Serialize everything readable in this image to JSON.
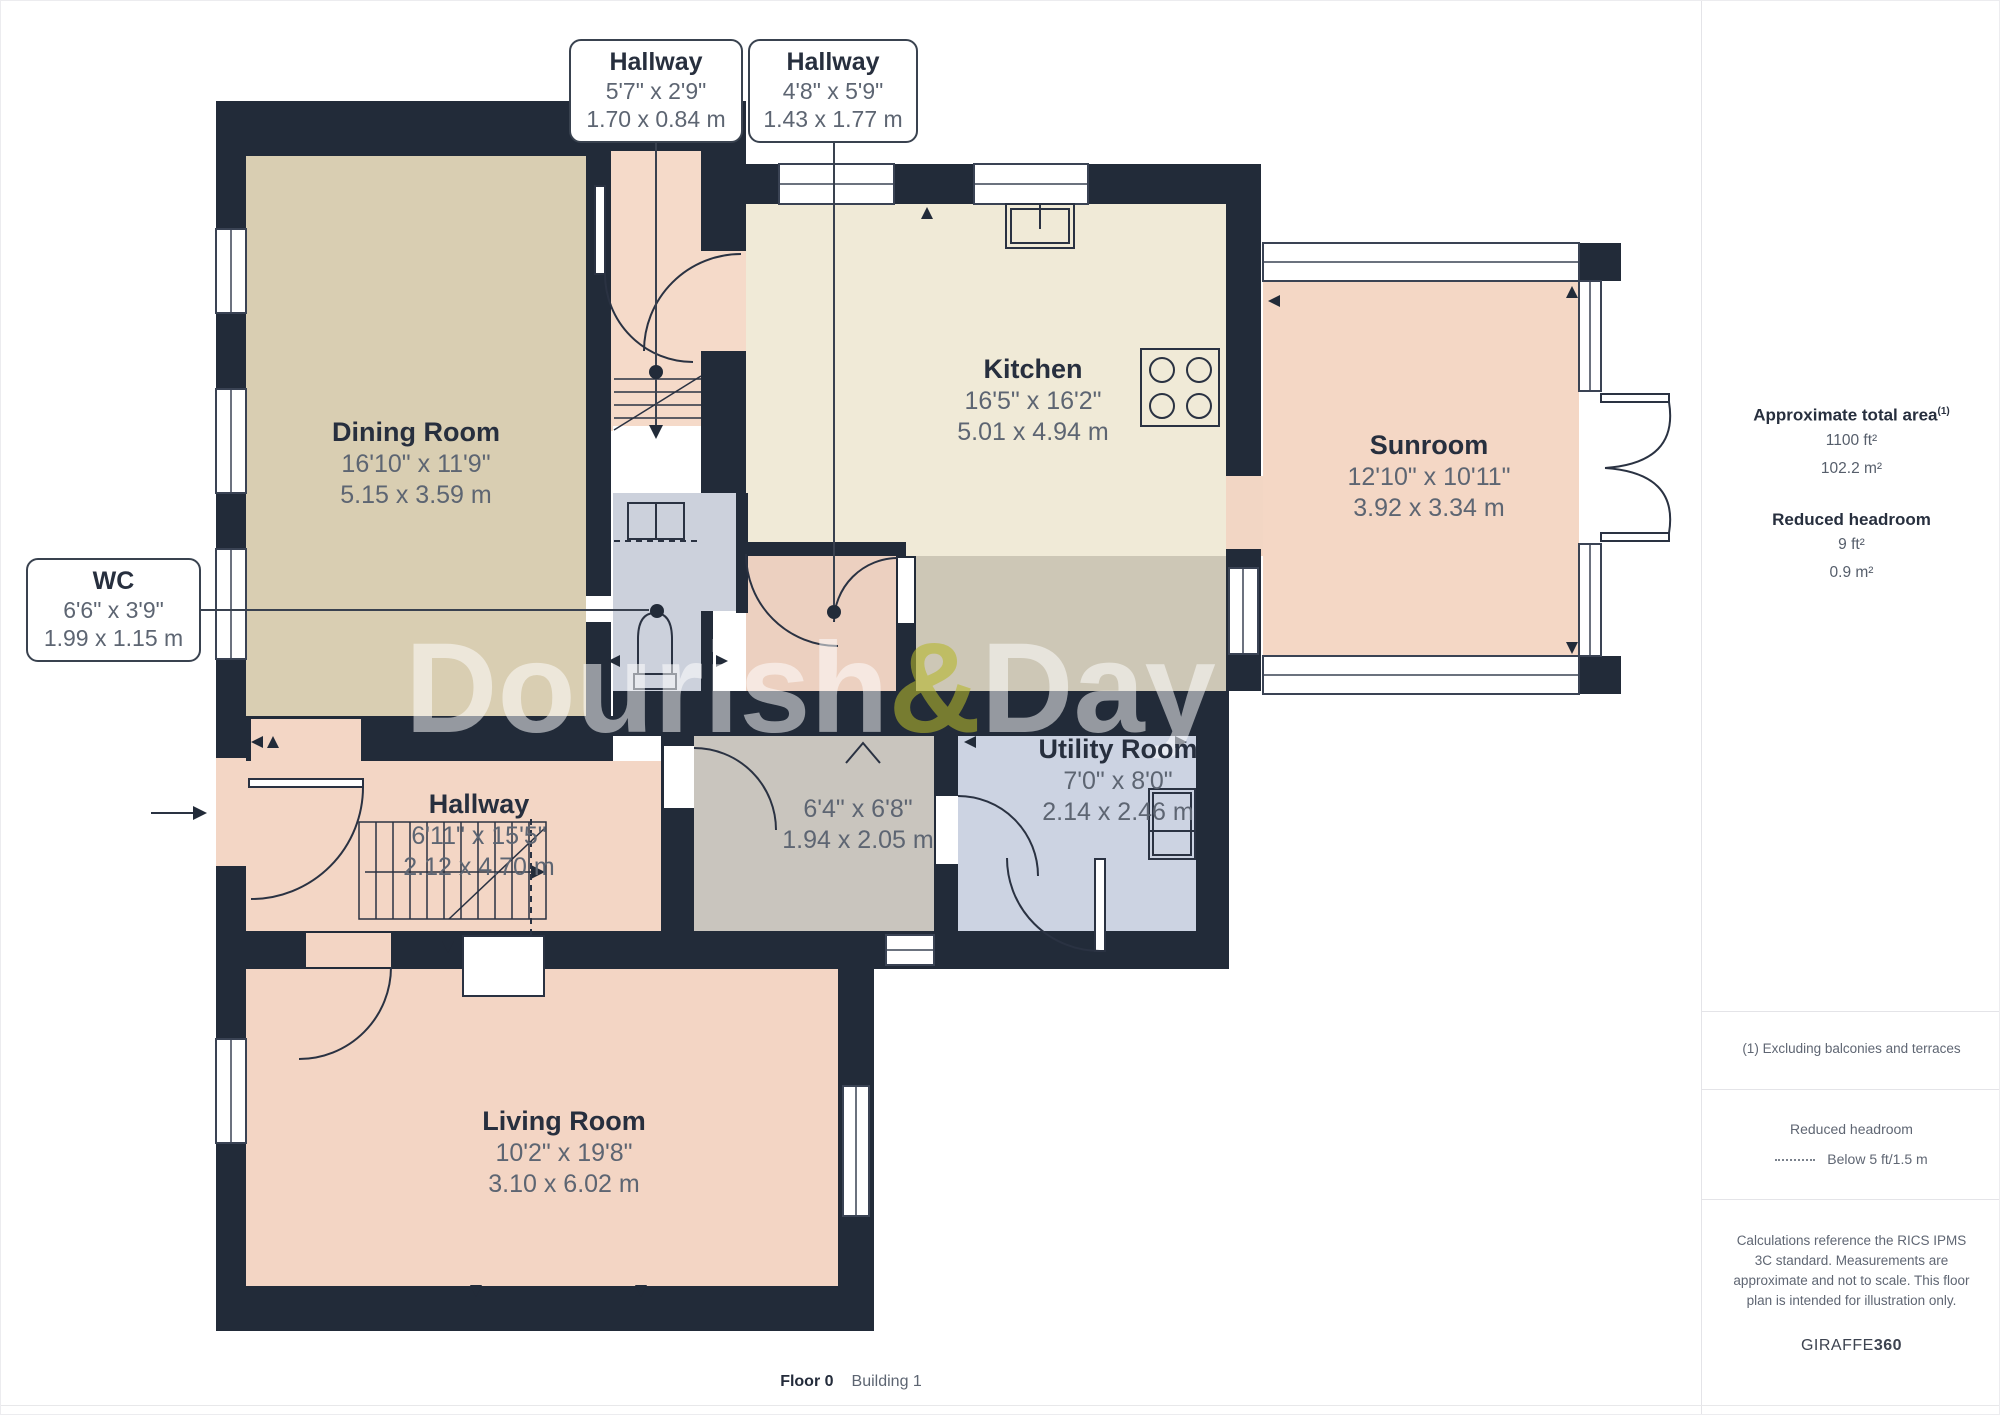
{
  "plan": {
    "watermark": {
      "left": "Dourish",
      "amp": "&",
      "right": "Day"
    },
    "callouts": [
      {
        "title": "Hallway",
        "imperial": "5'7\" x 2'9\"",
        "metric": "1.70 x 0.84 m"
      },
      {
        "title": "Hallway",
        "imperial": "4'8\" x 5'9\"",
        "metric": "1.43 x 1.77 m"
      },
      {
        "title": "WC",
        "imperial": "6'6\" x 3'9\"",
        "metric": "1.99 x 1.15 m"
      }
    ],
    "rooms": [
      {
        "name": "Dining Room",
        "imperial": "16'10\" x 11'9\"",
        "metric": "5.15 x 3.59 m"
      },
      {
        "name": "Kitchen",
        "imperial": "16'5\" x 16'2\"",
        "metric": "5.01 x 4.94 m"
      },
      {
        "name": "Sunroom",
        "imperial": "12'10\" x 10'11\"",
        "metric": "3.92 x 3.34 m"
      },
      {
        "name": "Utility Room",
        "imperial": "7'0\" x 8'0\"",
        "metric": "2.14 x 2.46 m"
      },
      {
        "name": "",
        "imperial": "6'4\" x 6'8\"",
        "metric": "1.94 x 2.05 m"
      },
      {
        "name": "Hallway",
        "imperial": "6'11\" x 15'5\"",
        "metric": "2.12 x 4.70 m"
      },
      {
        "name": "Living Room",
        "imperial": "10'2\" x 19'8\"",
        "metric": "3.10 x 6.02 m"
      }
    ]
  },
  "sidebar": {
    "area_title": "Approximate total area",
    "area_sup": "(1)",
    "area_ft": "1100 ft²",
    "area_m": "102.2 m²",
    "rh_title": "Reduced headroom",
    "rh_ft": "9 ft²",
    "rh_m": "0.9 m²",
    "note": "(1) Excluding balconies and terraces",
    "legend_title": "Reduced headroom",
    "legend_item": "Below 5 ft/1.5 m",
    "disclaimer": "Calculations reference the RICS IPMS 3C standard. Measurements are approximate and not to scale. This floor plan is intended for illustration only.",
    "brand_name": "GIRAFFE",
    "brand_num": "360"
  },
  "footer": {
    "floor": "Floor 0",
    "building": "Building 1"
  },
  "colors": {
    "wall": "#222b39",
    "dining_fill": "#d9ceb2",
    "kitchen_fill": "#f0ead7",
    "sunroom_fill": "#f4d7c5",
    "hallway_fill": "#f3d6c5",
    "living_fill": "#f3d5c4",
    "wc_fill": "#ccd1dc",
    "utility_fill": "#ccd3e2",
    "inner_room_fill": "#c9c5be",
    "corridor_fill": "#cdc7b6",
    "label_text": "#272f3e",
    "dim_text": "#5d6572",
    "watermark_amp": "#b5b72a"
  }
}
